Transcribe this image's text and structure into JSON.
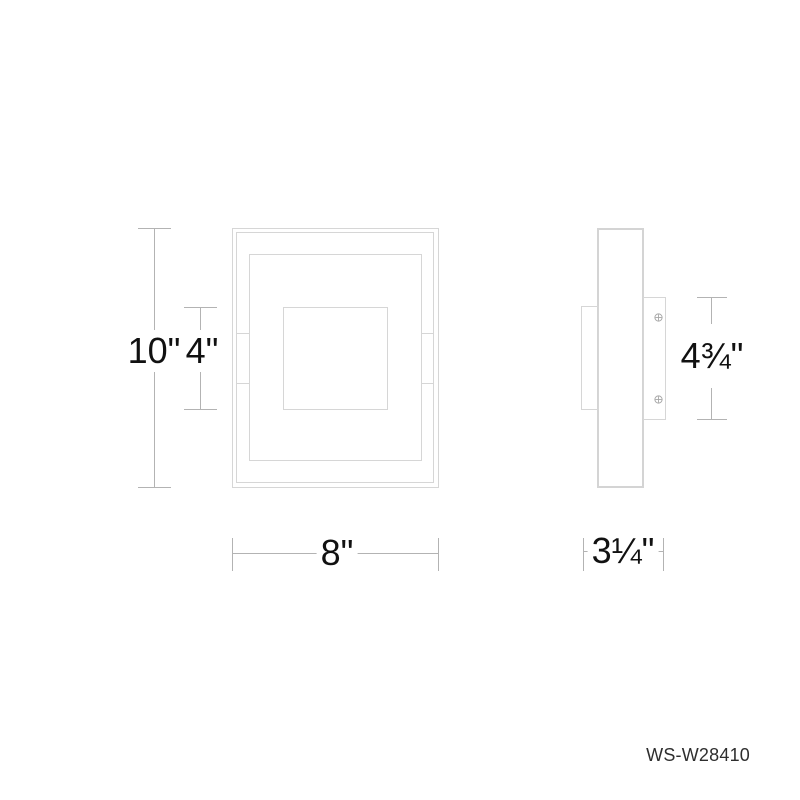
{
  "drawing": {
    "product_code": "WS-W28410",
    "views": [
      {
        "id": "front-view",
        "description": "front elevation of square wall sconce with nested frames"
      },
      {
        "id": "side-view",
        "description": "side profile with body, rear housing and mounting backplate with two screws"
      }
    ],
    "dimensions": {
      "overall_height": "10\"",
      "center_panel_height": "4\"",
      "overall_width": "8\"",
      "overall_depth": "3¼\"",
      "backplate_height": "4¾\""
    },
    "colors": {
      "background": "#ffffff",
      "fixture_line": "#d6d6d6",
      "dimension_line": "#b3b3b3",
      "label_text": "#111111",
      "product_code_text": "#2e2e2e"
    }
  }
}
